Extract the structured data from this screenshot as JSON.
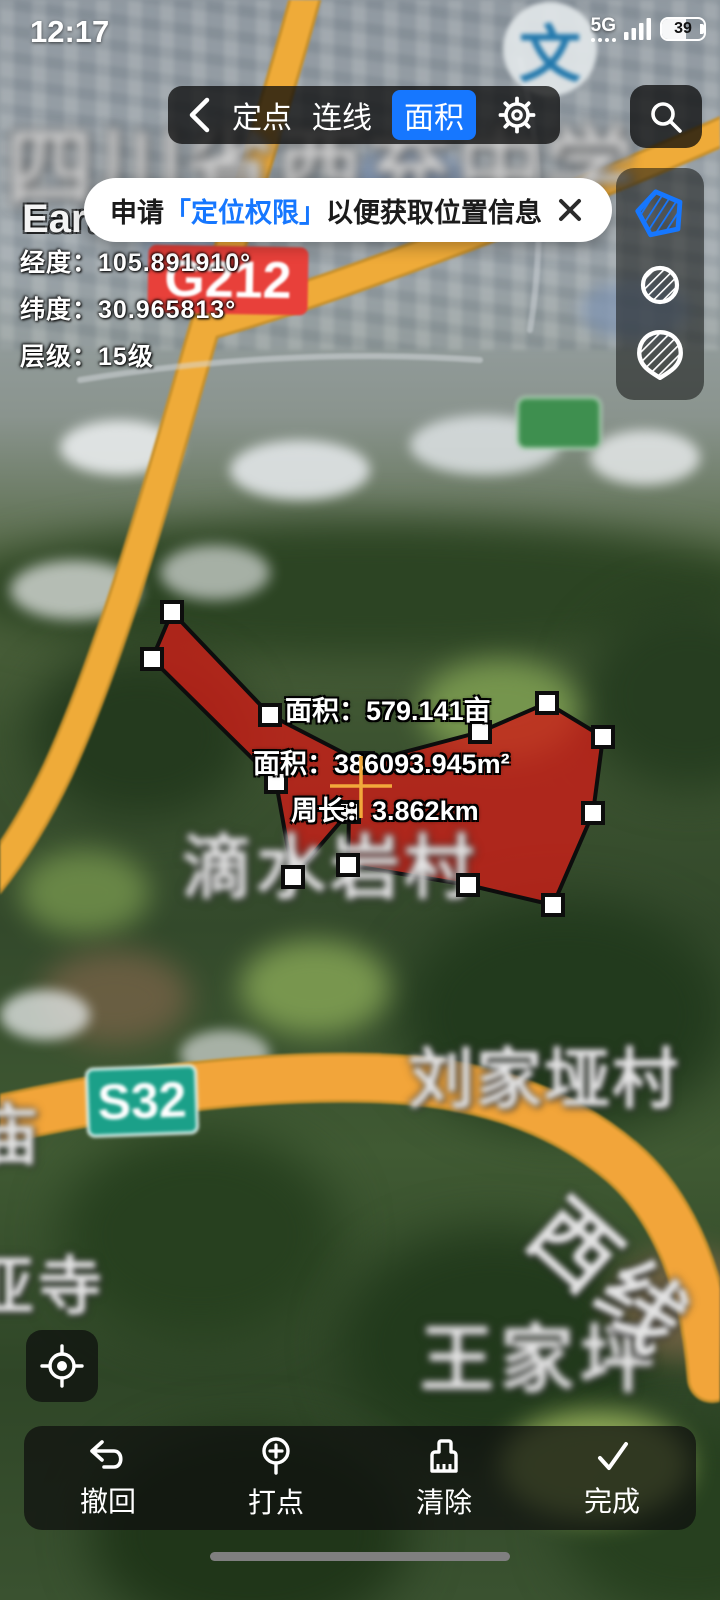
{
  "status_bar": {
    "time": "12:17",
    "network": "5G",
    "battery_percent": "39"
  },
  "nav_toolbar": {
    "tabs": [
      {
        "label": "定点",
        "active": false
      },
      {
        "label": "连线",
        "active": false
      },
      {
        "label": "面积",
        "active": true
      }
    ],
    "active_color": "#1677ff"
  },
  "permission_banner": {
    "text_prefix": "申请",
    "text_highlight": "「定位权限」",
    "text_suffix": "以便获取位置信息",
    "highlight_color": "#1677ff"
  },
  "app_watermark": {
    "label": "Earth 云地球"
  },
  "coord_info": {
    "longitude": {
      "label": "经度：",
      "value": "105.891910°"
    },
    "latitude": {
      "label": "纬度：",
      "value": "30.965813°"
    },
    "zoom_level": {
      "label": "层级：",
      "value": "15级"
    }
  },
  "measurements": {
    "area_mu": "面积：579.141亩",
    "area_m2": "面积：386093.945m²",
    "perimeter": "周长：3.862km"
  },
  "road_badges": {
    "national": "G212",
    "provincial": "S32",
    "national_color": "#e8403a",
    "provincial_color": "#1ba089"
  },
  "map_labels": {
    "school": "四川省西充中学",
    "school_poi": "文",
    "village_center": "滴水岩村",
    "village_east": "刘家垭村",
    "village_south": "王家坪",
    "temple_west": "亚寺",
    "edge_west": "庙",
    "road_side": "西线"
  },
  "action_bar": {
    "undo": "撤回",
    "add_point": "打点",
    "clear": "清除",
    "done": "完成"
  },
  "polygon": {
    "fill_color": "#d01d17",
    "vertex_count": 14
  }
}
